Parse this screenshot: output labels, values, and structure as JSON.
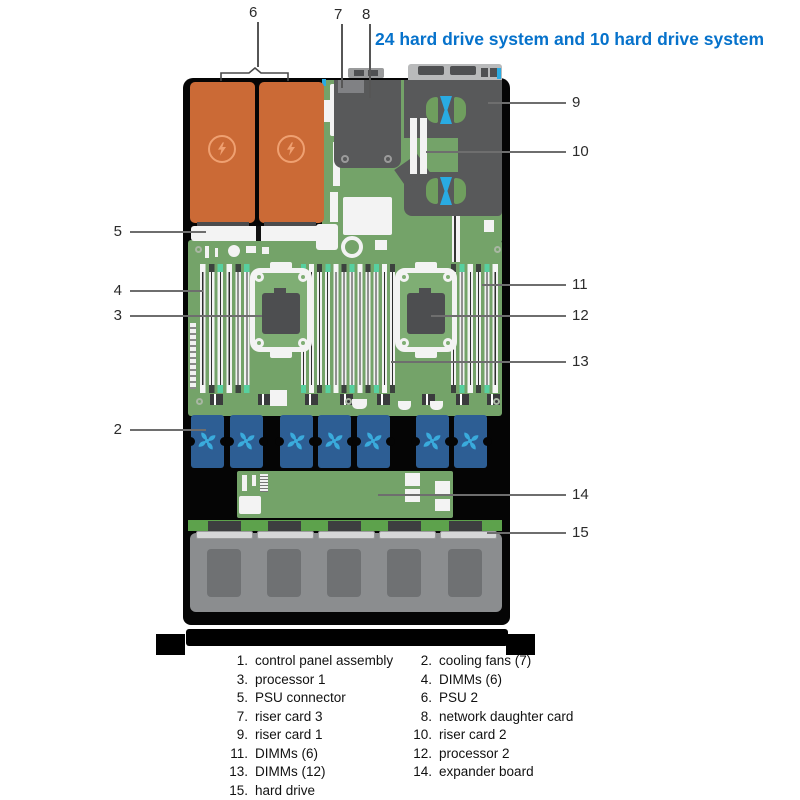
{
  "title": "24 hard drive system and 10 hard drive system",
  "diagram": {
    "type": "server-top-view",
    "callouts": {
      "fans": "2",
      "proc1": "3",
      "dimms_left": "4",
      "psu_connector": "5",
      "psu2": "6",
      "riser3": "7",
      "ndc": "8",
      "riser1": "9",
      "riser2": "10",
      "dimms_right": "11",
      "proc2": "12",
      "dimms_mid": "13",
      "expander": "14",
      "hard_drive": "15"
    },
    "icons": {
      "psu": "lightning-bolt-icon",
      "fan": "fan-blades-icon"
    },
    "colors": {
      "title_blue": "#0672cb",
      "psu_orange": "#cb6a36",
      "board_green": "#74a369",
      "backplane_green": "#5da24c",
      "fan_body_blue": "#2d5e94",
      "fan_blade_cyan": "#3aabdc",
      "card_gray": "#58595a",
      "drive_gray": "#8b8d8f",
      "latch_teal": "#57d0a0",
      "chassis_black": "#000000",
      "callout_line_gray": "#6b6b6b"
    }
  },
  "legend": {
    "left": [
      {
        "num": "1.",
        "label": "control panel assembly"
      },
      {
        "num": "3.",
        "label": "processor 1"
      },
      {
        "num": "5.",
        "label": "PSU connector"
      },
      {
        "num": "7.",
        "label": "riser card 3"
      },
      {
        "num": "9.",
        "label": "riser card 1"
      },
      {
        "num": "11.",
        "label": "DIMMs (6)"
      },
      {
        "num": "13.",
        "label": "DIMMs (12)"
      },
      {
        "num": "15.",
        "label": "hard drive"
      }
    ],
    "right": [
      {
        "num": "2.",
        "label": "cooling fans (7)"
      },
      {
        "num": "4.",
        "label": "DIMMs (6)"
      },
      {
        "num": "6.",
        "label": "PSU 2"
      },
      {
        "num": "8.",
        "label": "network daughter card"
      },
      {
        "num": "10.",
        "label": "riser card 2"
      },
      {
        "num": "12.",
        "label": "processor 2"
      },
      {
        "num": "14.",
        "label": "expander board"
      }
    ]
  }
}
